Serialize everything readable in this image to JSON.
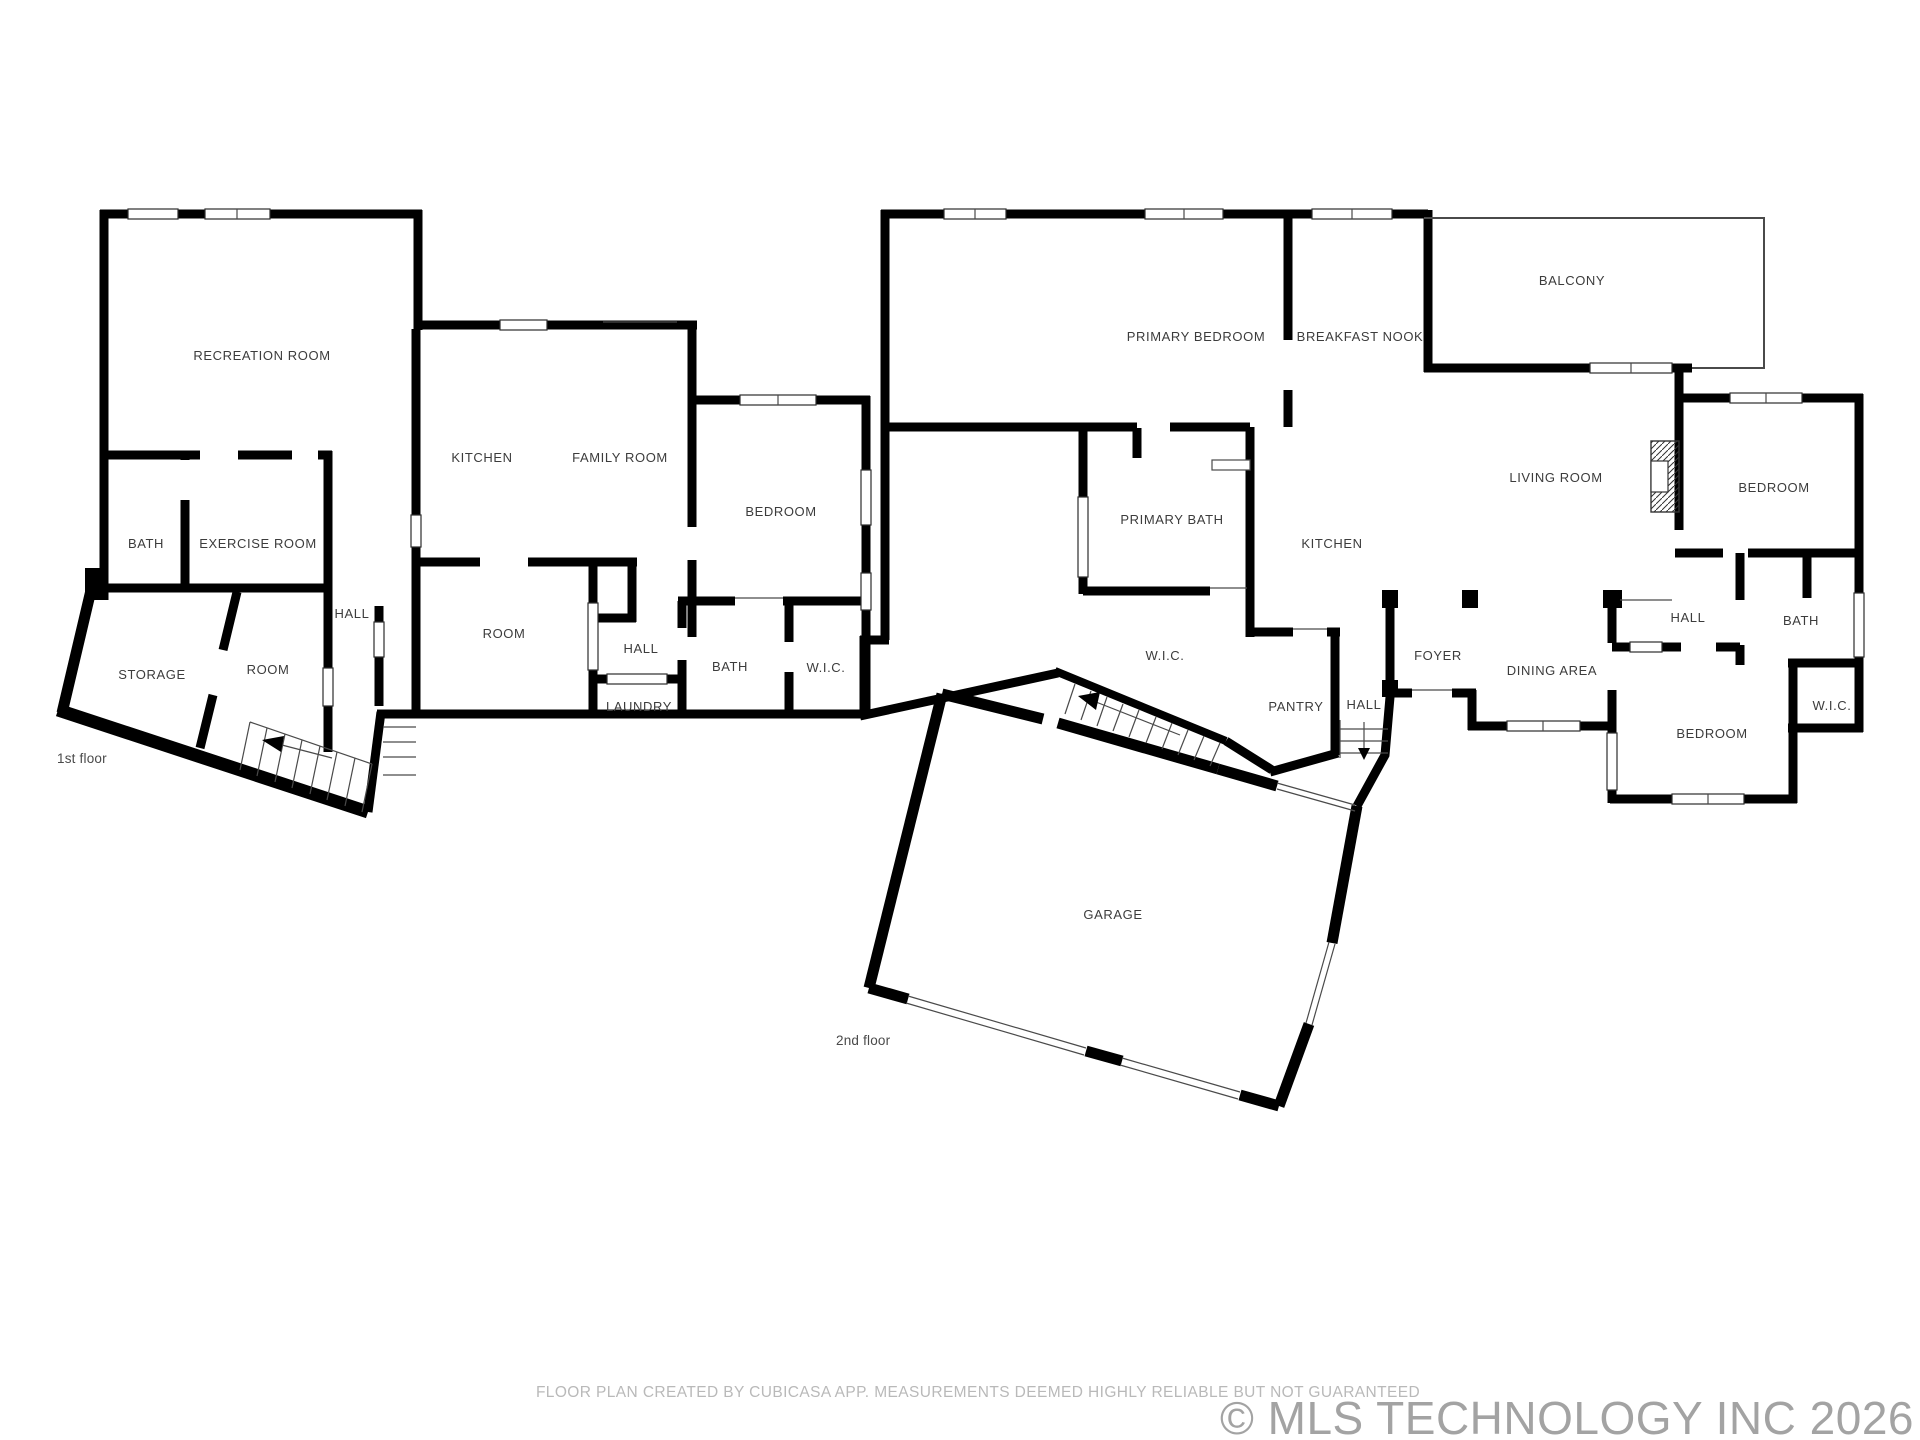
{
  "document": {
    "type": "floor-plan",
    "background": "#ffffff"
  },
  "colors": {
    "wall": "#000000",
    "room_label": "#3c3c3c",
    "caption": "#4a4a4a",
    "disclaimer_text": "#b9b9b9",
    "watermark_text": "#a3a3a3"
  },
  "floors": [
    {
      "caption": "1st floor",
      "rooms": [
        {
          "label": "RECREATION ROOM"
        },
        {
          "label": "KITCHEN"
        },
        {
          "label": "FAMILY ROOM"
        },
        {
          "label": "BATH"
        },
        {
          "label": "EXERCISE ROOM"
        },
        {
          "label": "BEDROOM"
        },
        {
          "label": "HALL"
        },
        {
          "label": "ROOM"
        },
        {
          "label": "STORAGE"
        },
        {
          "label": "ROOM"
        },
        {
          "label": "HALL"
        },
        {
          "label": "BATH"
        },
        {
          "label": "W.I.C."
        },
        {
          "label": "LAUNDRY"
        }
      ]
    },
    {
      "caption": "2nd floor",
      "rooms": [
        {
          "label": "PRIMARY BEDROOM"
        },
        {
          "label": "BREAKFAST NOOK"
        },
        {
          "label": "BALCONY"
        },
        {
          "label": "LIVING ROOM"
        },
        {
          "label": "PRIMARY BATH"
        },
        {
          "label": "KITCHEN"
        },
        {
          "label": "W.I.C."
        },
        {
          "label": "PANTRY"
        },
        {
          "label": "HALL"
        },
        {
          "label": "FOYER"
        },
        {
          "label": "DINING AREA"
        },
        {
          "label": "HALL"
        },
        {
          "label": "BATH"
        },
        {
          "label": "W.I.C."
        },
        {
          "label": "BEDROOM"
        },
        {
          "label": "BEDROOM"
        },
        {
          "label": "GARAGE"
        }
      ]
    }
  ],
  "footer": {
    "disclaimer": "FLOOR PLAN CREATED BY CUBICASA APP. MEASUREMENTS DEEMED HIGHLY RELIABLE BUT NOT GUARANTEED",
    "watermark": "© MLS TECHNOLOGY INC 2026"
  }
}
